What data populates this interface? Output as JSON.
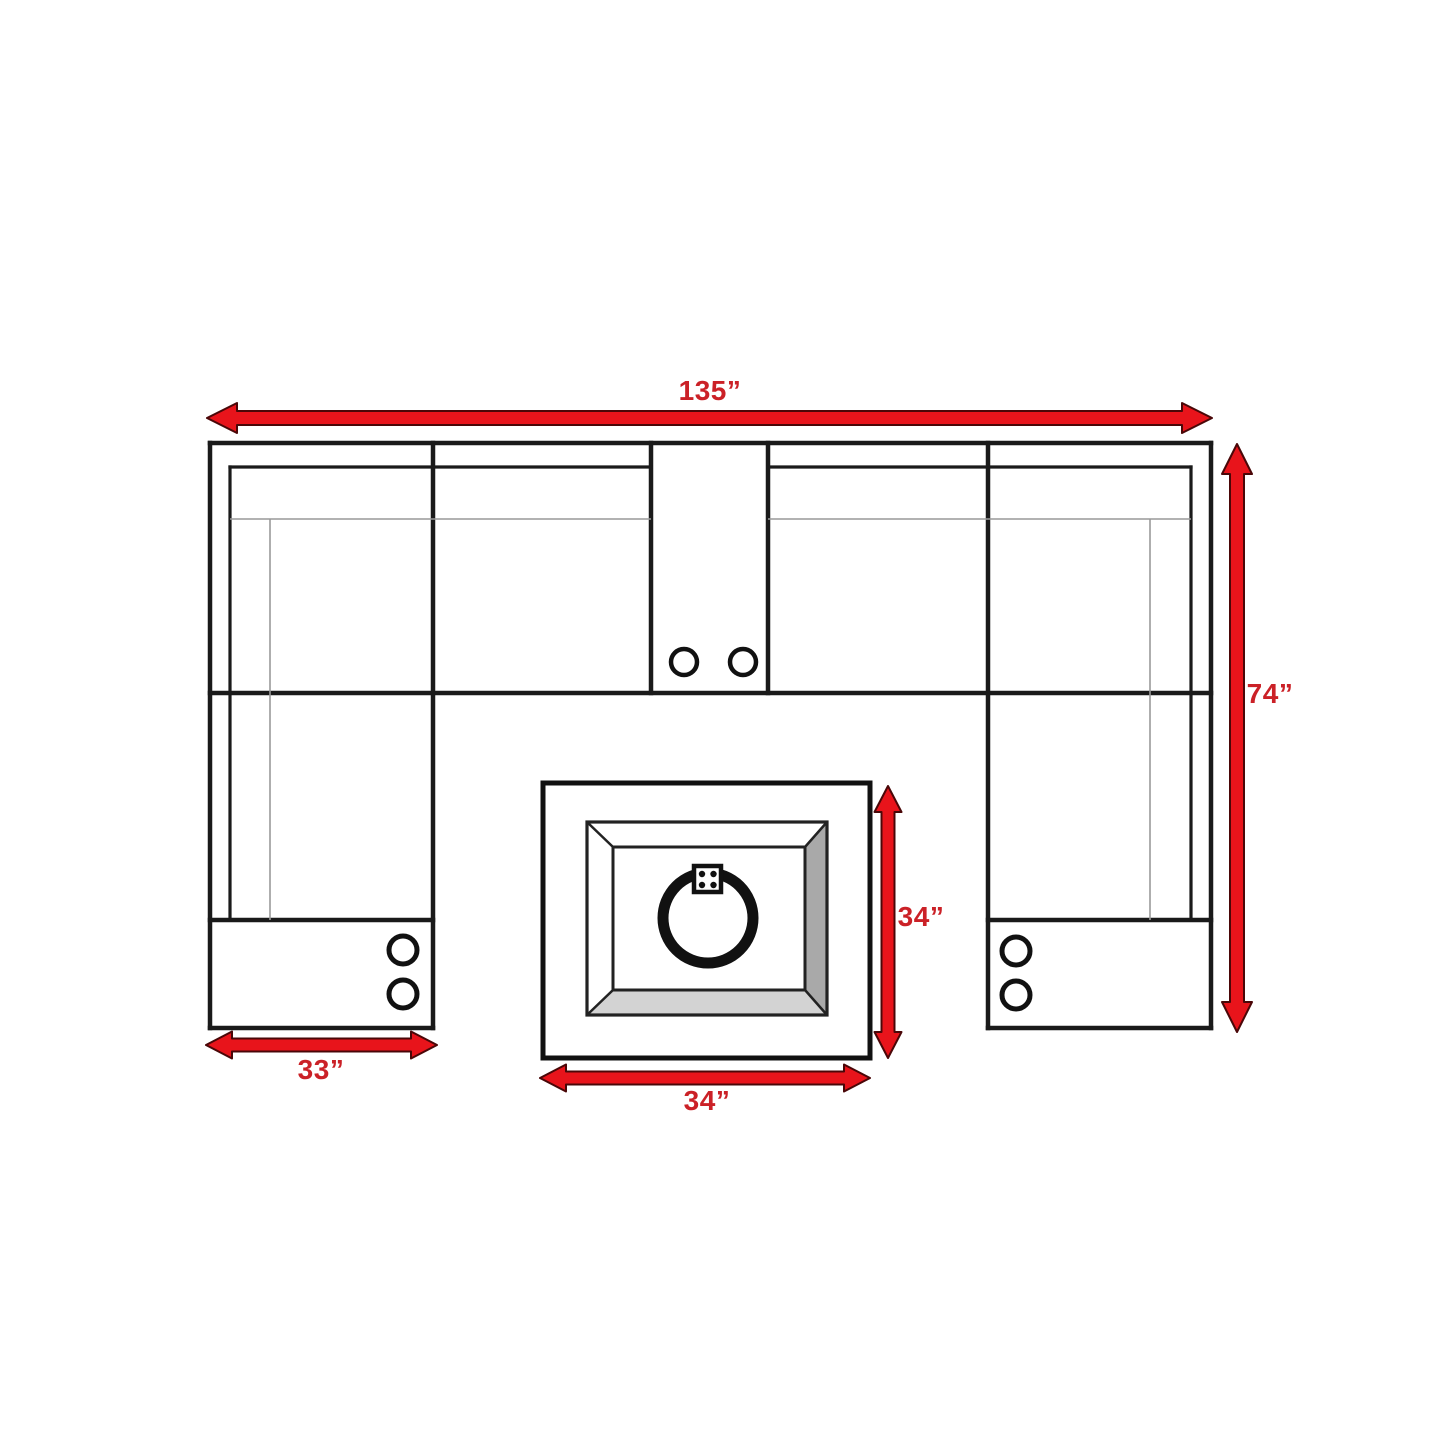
{
  "diagram": {
    "labels": {
      "overall_width": "135”",
      "overall_depth": "74”",
      "left_section_width": "33”",
      "fire_table_width": "34”",
      "fire_table_depth": "34”"
    },
    "colors": {
      "arrow_red": "#e8141b",
      "arrow_outline": "#4a0708",
      "label_red": "#cb2127",
      "line_black": "#1a1a1a",
      "seam_gray": "#999999",
      "bevel_side_gray": "#a9a9a9",
      "bevel_bottom_gray": "#d3d3d3"
    }
  }
}
